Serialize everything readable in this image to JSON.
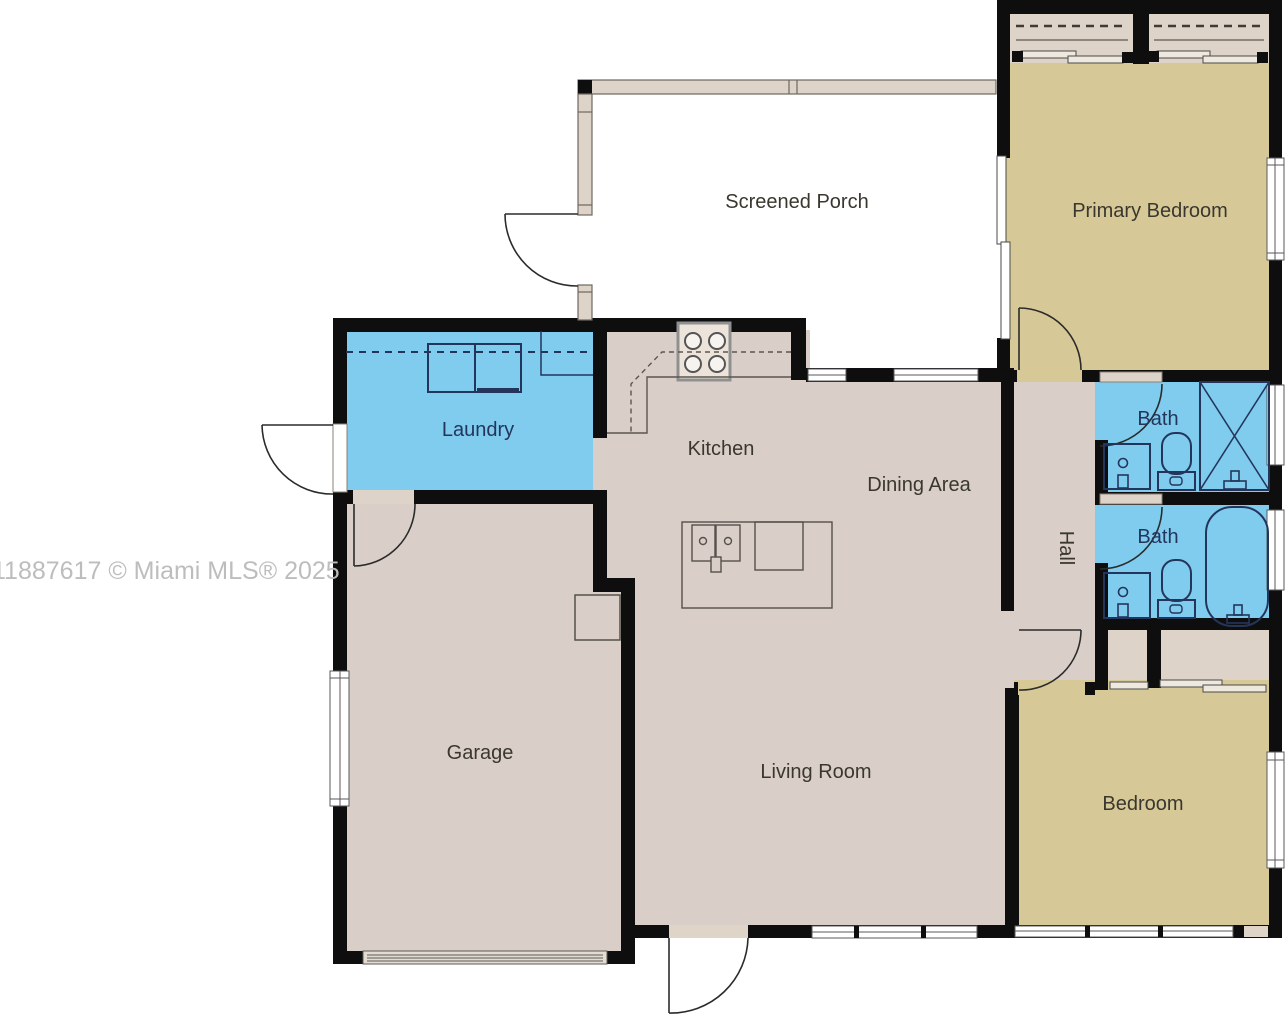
{
  "watermark": "11887617 © Miami MLS® 2025",
  "rooms": {
    "screened_porch": {
      "label": "Screened Porch"
    },
    "primary_bedroom": {
      "label": "Primary Bedroom"
    },
    "laundry": {
      "label": "Laundry"
    },
    "kitchen": {
      "label": "Kitchen"
    },
    "dining_area": {
      "label": "Dining Area"
    },
    "bath_upper": {
      "label": "Bath"
    },
    "bath_lower": {
      "label": "Bath"
    },
    "hall": {
      "label": "Hall"
    },
    "garage": {
      "label": "Garage"
    },
    "living_room": {
      "label": "Living Room"
    },
    "bedroom": {
      "label": "Bedroom"
    }
  },
  "fixtures": [
    "washer",
    "dryer",
    "stove",
    "island-double-sink",
    "dishwasher",
    "shower",
    "bathtub",
    "toilet",
    "vanity-sink",
    "water-heater",
    "sliding-closet-doors"
  ],
  "colors": {
    "wall": "#0e0e0e",
    "floor_main": "#d9cfc8",
    "floor_bedroom": "#d6c997",
    "floor_wet": "#7fccee",
    "closet_fill": "#ddd3c8",
    "porch_wall_fill": "#ddd3c8",
    "fixture_line": "#24355c",
    "counter_line": "#5c564e",
    "window_frame": "#5a5a5a",
    "label_text": "#3a372f",
    "wet_label_text": "#24355c",
    "watermark_text": "#bdbdbd"
  }
}
